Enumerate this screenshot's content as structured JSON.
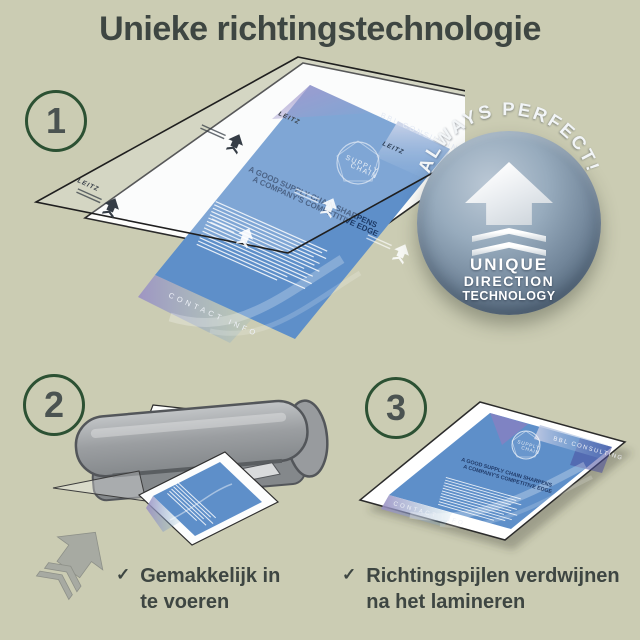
{
  "title": "Unieke richtingstechnologie",
  "colors": {
    "background": "#cbccb3",
    "text": "#3e4642",
    "step_circle_border": "#2c5133",
    "flyer_blue": "#5e8fc9",
    "flyer_accent_purple": "#8b7fc0",
    "badge_sphere": "#74889c",
    "machine_gray": "#9a9da0",
    "badge_text": "#ffffff"
  },
  "steps": [
    {
      "number": "1"
    },
    {
      "number": "2"
    },
    {
      "number": "3"
    }
  ],
  "badge": {
    "arc_text": "ALWAYS PERFECT!",
    "lines": [
      "UNIQUE",
      "DIRECTION",
      "TECHNOLOGY"
    ]
  },
  "flyer": {
    "brand": "LEITZ",
    "company": "BBL CONSULTING",
    "logo_line1": "SUPPLY",
    "logo_line2": "CHAIN",
    "headline_line1": "A GOOD SUPPLY CHAIN SHARPENS",
    "headline_line2": "A COMPANY'S COMPETITIVE EDGE",
    "footer": "CONTACT INFO"
  },
  "captions": [
    {
      "check": "✓",
      "line1": "Gemakkelijk in",
      "line2": "te voeren"
    },
    {
      "check": "✓",
      "line1": "Richtingspijlen verdwijnen",
      "line2": "na het lamineren"
    }
  ]
}
